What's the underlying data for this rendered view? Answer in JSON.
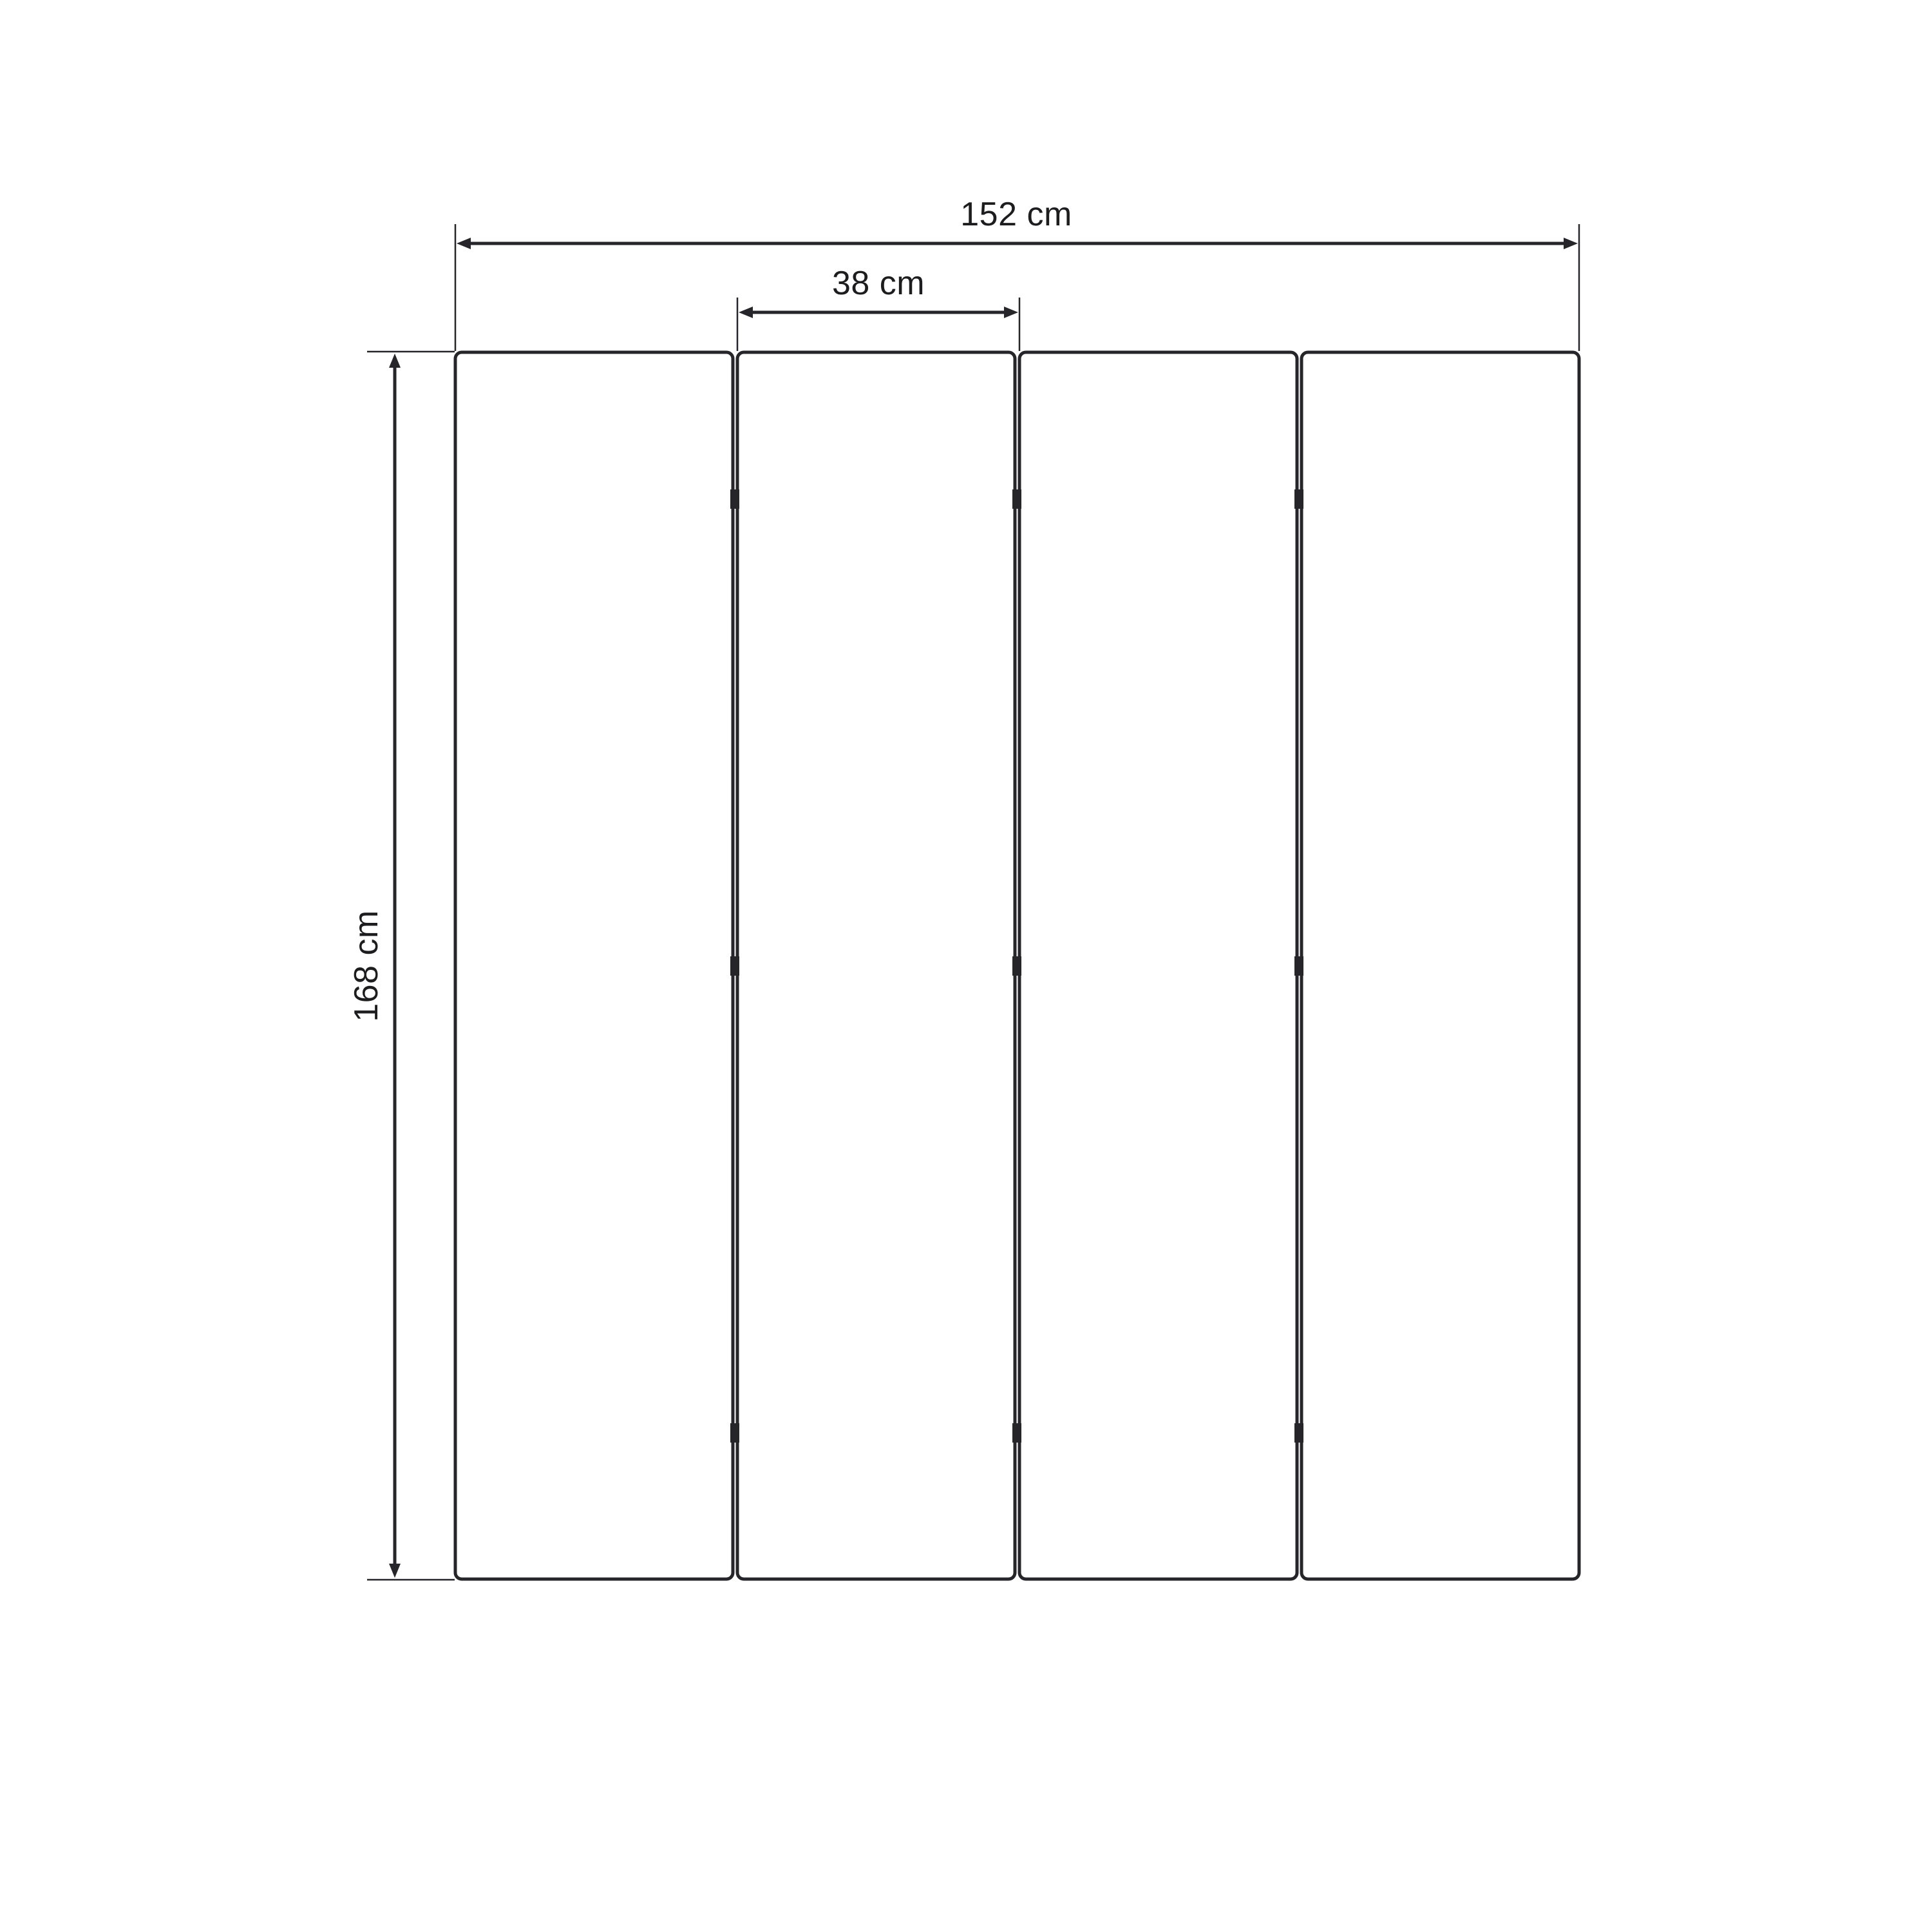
{
  "page": {
    "background": "#ffffff",
    "description": "Technical dimension drawing of a four-panel folding screen (room divider), front elevation view on a plain white background"
  },
  "diagram": {
    "object": "four-panel folding screen",
    "view": "front elevation",
    "units": "cm",
    "panel_count": 4,
    "hinge_junctions": 3,
    "hinge_rows_per_junction": 3,
    "dimensions": {
      "total_width": {
        "value": 152,
        "unit": "cm",
        "label": "152 cm"
      },
      "panel_width": {
        "value": 38,
        "unit": "cm",
        "label": "38 cm"
      },
      "height": {
        "value": 168,
        "unit": "cm",
        "label": "168 cm"
      }
    },
    "colors": {
      "line": "#26262a",
      "text": "#1d1d1f",
      "panel_fill": "#ffffff",
      "background": "#ffffff"
    }
  }
}
